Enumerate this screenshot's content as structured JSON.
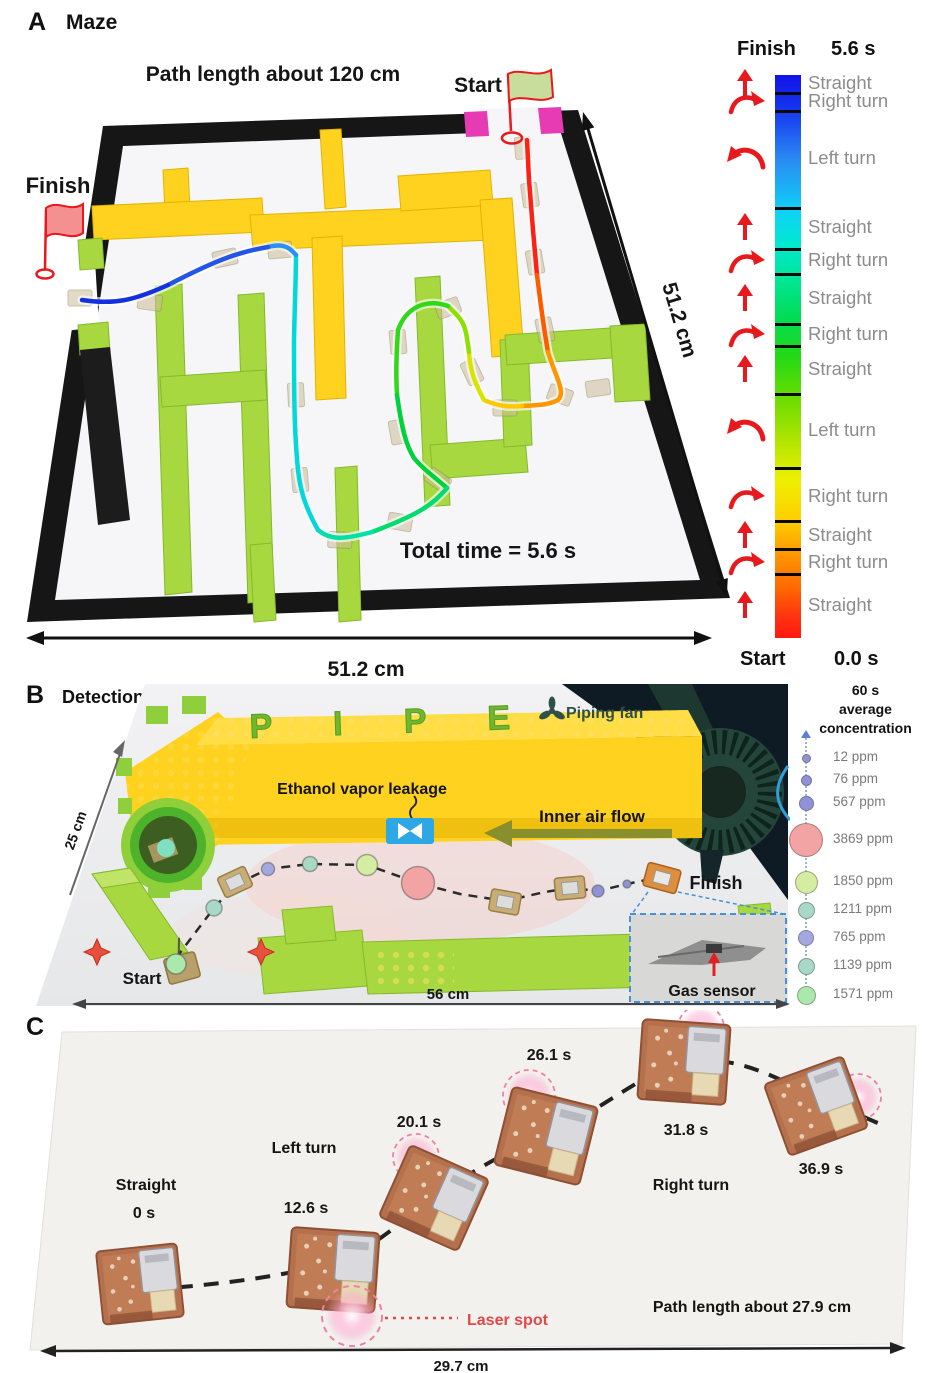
{
  "panelA": {
    "label": "A",
    "title": "Maze",
    "path_length": "Path length about 120 cm",
    "start_label": "Start",
    "finish_label": "Finish",
    "total_time": "Total time = 5.6 s",
    "dim_bottom": "51.2 cm",
    "dim_right": "51.2 cm",
    "legend": {
      "finish_label": "Finish",
      "finish_time": "5.6 s",
      "start_label": "Start",
      "start_time": "0.0 s",
      "segments": [
        {
          "action": "Straight",
          "arrow": "up"
        },
        {
          "action": "Right turn",
          "arrow": "right-curve"
        },
        {
          "action": "Left turn",
          "arrow": "left-curve"
        },
        {
          "action": "Straight",
          "arrow": "up"
        },
        {
          "action": "Right turn",
          "arrow": "right-curve"
        },
        {
          "action": "Straight",
          "arrow": "up"
        },
        {
          "action": "Right turn",
          "arrow": "right-curve"
        },
        {
          "action": "Straight",
          "arrow": "up"
        },
        {
          "action": "Left turn",
          "arrow": "left-curve"
        },
        {
          "action": "Right turn",
          "arrow": "right-curve"
        },
        {
          "action": "Straight",
          "arrow": "up"
        },
        {
          "action": "Right turn",
          "arrow": "right-curve"
        },
        {
          "action": "Straight",
          "arrow": "up"
        }
      ]
    }
  },
  "panelB": {
    "label": "B",
    "title": "Detection",
    "dim_left": "25 cm",
    "dim_bottom": "56 cm",
    "ethanol_label": "Ethanol vapor leakage",
    "fan_label": "Piping fan",
    "airflow_label": "Inner air flow",
    "start_label": "Start",
    "finish_label": "Finish",
    "gas_sensor_label": "Gas sensor",
    "pipe_text": "P I P E",
    "legend": {
      "title_line1": "60 s",
      "title_line2": "average",
      "title_line3": "concentration",
      "items": [
        {
          "value": "12 ppm",
          "color": "#9193ce"
        },
        {
          "value": "76 ppm",
          "color": "#8f92d6"
        },
        {
          "value": "567 ppm",
          "color": "#8f92d6"
        },
        {
          "value": "3869 ppm",
          "color": "#f2a3a3"
        },
        {
          "value": "1850 ppm",
          "color": "#d4eda3"
        },
        {
          "value": "1211 ppm",
          "color": "#a8d8c8"
        },
        {
          "value": "765 ppm",
          "color": "#a3a8e0"
        },
        {
          "value": "1139 ppm",
          "color": "#a8d8c8"
        },
        {
          "value": "1571 ppm",
          "color": "#abe8ab"
        }
      ]
    },
    "path_bubbles": [
      {
        "color": "#abe8ab"
      },
      {
        "color": "#a8d8c8"
      },
      {
        "color": "#a3a8e0"
      },
      {
        "color": "#a8d8c8"
      },
      {
        "color": "#d4eda3"
      },
      {
        "color": "#f2a3a3"
      },
      {
        "color": "#8f92d6"
      },
      {
        "color": "#9193ce"
      }
    ]
  },
  "panelC": {
    "label": "C",
    "maneuver_straight": "Straight",
    "maneuver_left": "Left turn",
    "maneuver_right": "Right turn",
    "times": [
      "0 s",
      "12.6 s",
      "20.1 s",
      "26.1 s",
      "31.8 s",
      "36.9 s"
    ],
    "laser_spot_label": "Laser spot",
    "path_length": "Path length about 27.9 cm",
    "dim_bottom": "29.7 cm"
  },
  "colors": {
    "legend_arrow_red": "#e8191c",
    "colorbar_finish_blue": "#1212e8",
    "colorbar_start_red": "#ff1810",
    "legend_text_gray": "#8c8c8c",
    "maze_yellow": "#ffd21f",
    "maze_green": "#a8d840",
    "start_block_magenta": "#e73bb4",
    "finish_flag_red": "#f59090",
    "start_flag_green": "#c8dc9c",
    "fan_teal": "#2e5048",
    "airflow_olive": "#8a8f2e",
    "leak_blue": "#2ea7e6",
    "laser_pink": "#f080a8"
  }
}
